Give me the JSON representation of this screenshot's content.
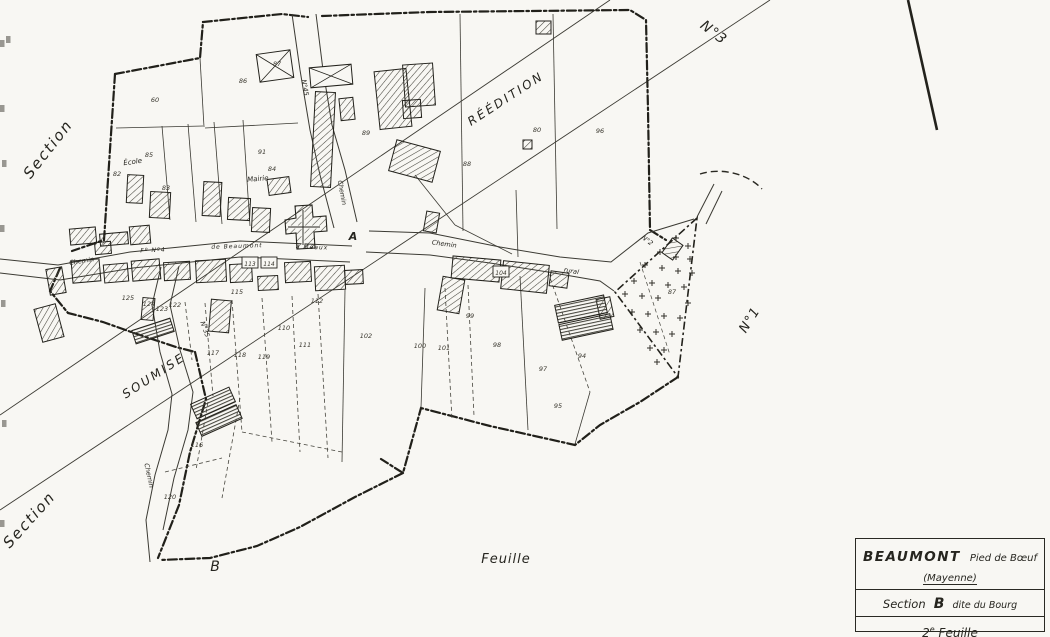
{
  "colors": {
    "paper": "#f8f7f3",
    "ink": "#26251f",
    "line": "#3b3a33"
  },
  "map": {
    "labels": [
      {
        "id": "section-top-left",
        "t": "Section",
        "x": 52,
        "y": 152,
        "r": -52,
        "s": 15,
        "ls": 2,
        "b": false
      },
      {
        "id": "section-bottom-left",
        "t": "Section",
        "x": 33,
        "y": 523,
        "r": -48,
        "s": 15,
        "ls": 2,
        "b": false
      },
      {
        "id": "reedition",
        "t": "RÉÉDITION",
        "x": 508,
        "y": 102,
        "r": -33,
        "s": 12,
        "ls": 2.5,
        "b": false
      },
      {
        "id": "soumise",
        "t": "SOUMISE",
        "x": 156,
        "y": 379,
        "r": -33,
        "s": 12,
        "ls": 2.5,
        "b": false
      },
      {
        "id": "no3",
        "t": "N°3",
        "x": 711,
        "y": 36,
        "r": 38,
        "s": 14,
        "ls": 1,
        "b": false
      },
      {
        "id": "no1",
        "t": "N°1",
        "x": 753,
        "y": 322,
        "r": -58,
        "s": 13,
        "ls": 1,
        "b": false
      },
      {
        "id": "letter-b",
        "t": "B",
        "x": 215,
        "y": 571,
        "r": 0,
        "s": 14,
        "ls": 0,
        "b": false
      },
      {
        "id": "feuille",
        "t": "Feuille",
        "x": 506,
        "y": 563,
        "r": 0,
        "s": 13,
        "ls": 1,
        "b": false
      },
      {
        "id": "junction-a",
        "t": "A",
        "x": 353,
        "y": 240,
        "r": 0,
        "s": 11,
        "ls": 0,
        "b": true
      },
      {
        "id": "ecole",
        "t": "École",
        "x": 133,
        "y": 164,
        "r": -8,
        "s": 7,
        "ls": 0,
        "b": false
      },
      {
        "id": "mairie",
        "t": "Mairie",
        "x": 258,
        "y": 181,
        "r": -5,
        "s": 7,
        "ls": 0,
        "b": false
      },
      {
        "id": "chemin-north",
        "t": "Chemin",
        "x": 340,
        "y": 193,
        "r": 80,
        "s": 6.5,
        "ls": 0,
        "b": false
      },
      {
        "id": "no45",
        "t": "N°45",
        "x": 303,
        "y": 88,
        "r": 80,
        "s": 6.5,
        "ls": 0,
        "b": false
      },
      {
        "id": "chemin-east",
        "t": "Chemin",
        "x": 444,
        "y": 246,
        "r": 8,
        "s": 6.5,
        "ls": 0,
        "b": false
      },
      {
        "id": "rural",
        "t": "rural",
        "x": 571,
        "y": 273,
        "r": 10,
        "s": 6.5,
        "ls": 0,
        "b": false
      },
      {
        "id": "fo-no4",
        "t": "Fº Nº4",
        "x": 153,
        "y": 252,
        "r": -2,
        "s": 6,
        "ls": 1,
        "b": false
      },
      {
        "id": "de-beaumont",
        "t": "de Beaumont",
        "x": 237,
        "y": 248,
        "r": -2,
        "s": 6,
        "ls": 1,
        "b": false
      },
      {
        "id": "a-meaux",
        "t": "à Méaux",
        "x": 312,
        "y": 249,
        "r": 2,
        "s": 6,
        "ls": 1,
        "b": false
      },
      {
        "id": "chemin-west",
        "t": "Chemin",
        "x": 82,
        "y": 263,
        "r": -9,
        "s": 6.5,
        "ls": 0,
        "b": false
      },
      {
        "id": "no35",
        "t": "N°35",
        "x": 203,
        "y": 330,
        "r": 70,
        "s": 6.5,
        "ls": 0,
        "b": false
      },
      {
        "id": "chemin-south",
        "t": "Chemin",
        "x": 147,
        "y": 476,
        "r": 78,
        "s": 6.5,
        "ls": 0,
        "b": false
      },
      {
        "id": "no2",
        "t": "N°2",
        "x": 646,
        "y": 242,
        "r": 38,
        "s": 6.5,
        "ls": 0,
        "b": false
      }
    ],
    "parcel_numbers": [
      {
        "n": "60",
        "x": 155,
        "y": 102
      },
      {
        "n": "86",
        "x": 243,
        "y": 83
      },
      {
        "n": "87",
        "x": 277,
        "y": 66
      },
      {
        "n": "80",
        "x": 537,
        "y": 132
      },
      {
        "n": "96",
        "x": 600,
        "y": 133
      },
      {
        "n": "85",
        "x": 149,
        "y": 157
      },
      {
        "n": "84",
        "x": 272,
        "y": 171
      },
      {
        "n": "82",
        "x": 117,
        "y": 176
      },
      {
        "n": "83",
        "x": 166,
        "y": 190
      },
      {
        "n": "88",
        "x": 467,
        "y": 166
      },
      {
        "n": "89",
        "x": 366,
        "y": 135
      },
      {
        "n": "91",
        "x": 262,
        "y": 154
      },
      {
        "n": "125",
        "x": 128,
        "y": 300
      },
      {
        "n": "124",
        "x": 149,
        "y": 306
      },
      {
        "n": "123",
        "x": 162,
        "y": 311
      },
      {
        "n": "122",
        "x": 175,
        "y": 307
      },
      {
        "n": "115",
        "x": 237,
        "y": 294
      },
      {
        "n": "112",
        "x": 317,
        "y": 303
      },
      {
        "n": "110",
        "x": 284,
        "y": 330
      },
      {
        "n": "111",
        "x": 305,
        "y": 347
      },
      {
        "n": "117",
        "x": 213,
        "y": 355
      },
      {
        "n": "118",
        "x": 240,
        "y": 357
      },
      {
        "n": "119",
        "x": 264,
        "y": 359
      },
      {
        "n": "116",
        "x": 197,
        "y": 447
      },
      {
        "n": "120",
        "x": 170,
        "y": 499
      },
      {
        "n": "99",
        "x": 470,
        "y": 318
      },
      {
        "n": "102",
        "x": 366,
        "y": 338
      },
      {
        "n": "100",
        "x": 420,
        "y": 348
      },
      {
        "n": "101",
        "x": 444,
        "y": 350
      },
      {
        "n": "98",
        "x": 497,
        "y": 347
      },
      {
        "n": "97",
        "x": 543,
        "y": 371
      },
      {
        "n": "94",
        "x": 582,
        "y": 358
      },
      {
        "n": "95",
        "x": 558,
        "y": 408
      },
      {
        "n": "87",
        "x": 672,
        "y": 294
      }
    ],
    "boxed_numbers": [
      {
        "n": "113",
        "x": 250,
        "y": 263
      },
      {
        "n": "114",
        "x": 269,
        "y": 263
      },
      {
        "n": "104",
        "x": 501,
        "y": 272
      }
    ],
    "cemetery_crosses": [
      [
        676,
        238
      ],
      [
        688,
        246
      ],
      [
        660,
        252
      ],
      [
        676,
        257
      ],
      [
        690,
        259
      ],
      [
        645,
        265
      ],
      [
        662,
        268
      ],
      [
        678,
        271
      ],
      [
        692,
        273
      ],
      [
        634,
        281
      ],
      [
        652,
        283
      ],
      [
        668,
        285
      ],
      [
        684,
        287
      ],
      [
        625,
        294
      ],
      [
        642,
        296
      ],
      [
        658,
        298
      ],
      [
        688,
        303
      ],
      [
        632,
        312
      ],
      [
        648,
        314
      ],
      [
        664,
        316
      ],
      [
        680,
        318
      ],
      [
        640,
        330
      ],
      [
        656,
        332
      ],
      [
        672,
        334
      ],
      [
        650,
        348
      ],
      [
        664,
        350
      ],
      [
        657,
        362
      ]
    ]
  },
  "title_block": {
    "name": "BEAUMONT",
    "subtitle": "Pied de Bœuf",
    "dept": "(Mayenne)",
    "section_word": "Section",
    "section_letter": "B",
    "section_rest": "dite du Bourg",
    "sheet_num": "2",
    "sheet_sup": "e",
    "sheet_word": "Feuille"
  }
}
